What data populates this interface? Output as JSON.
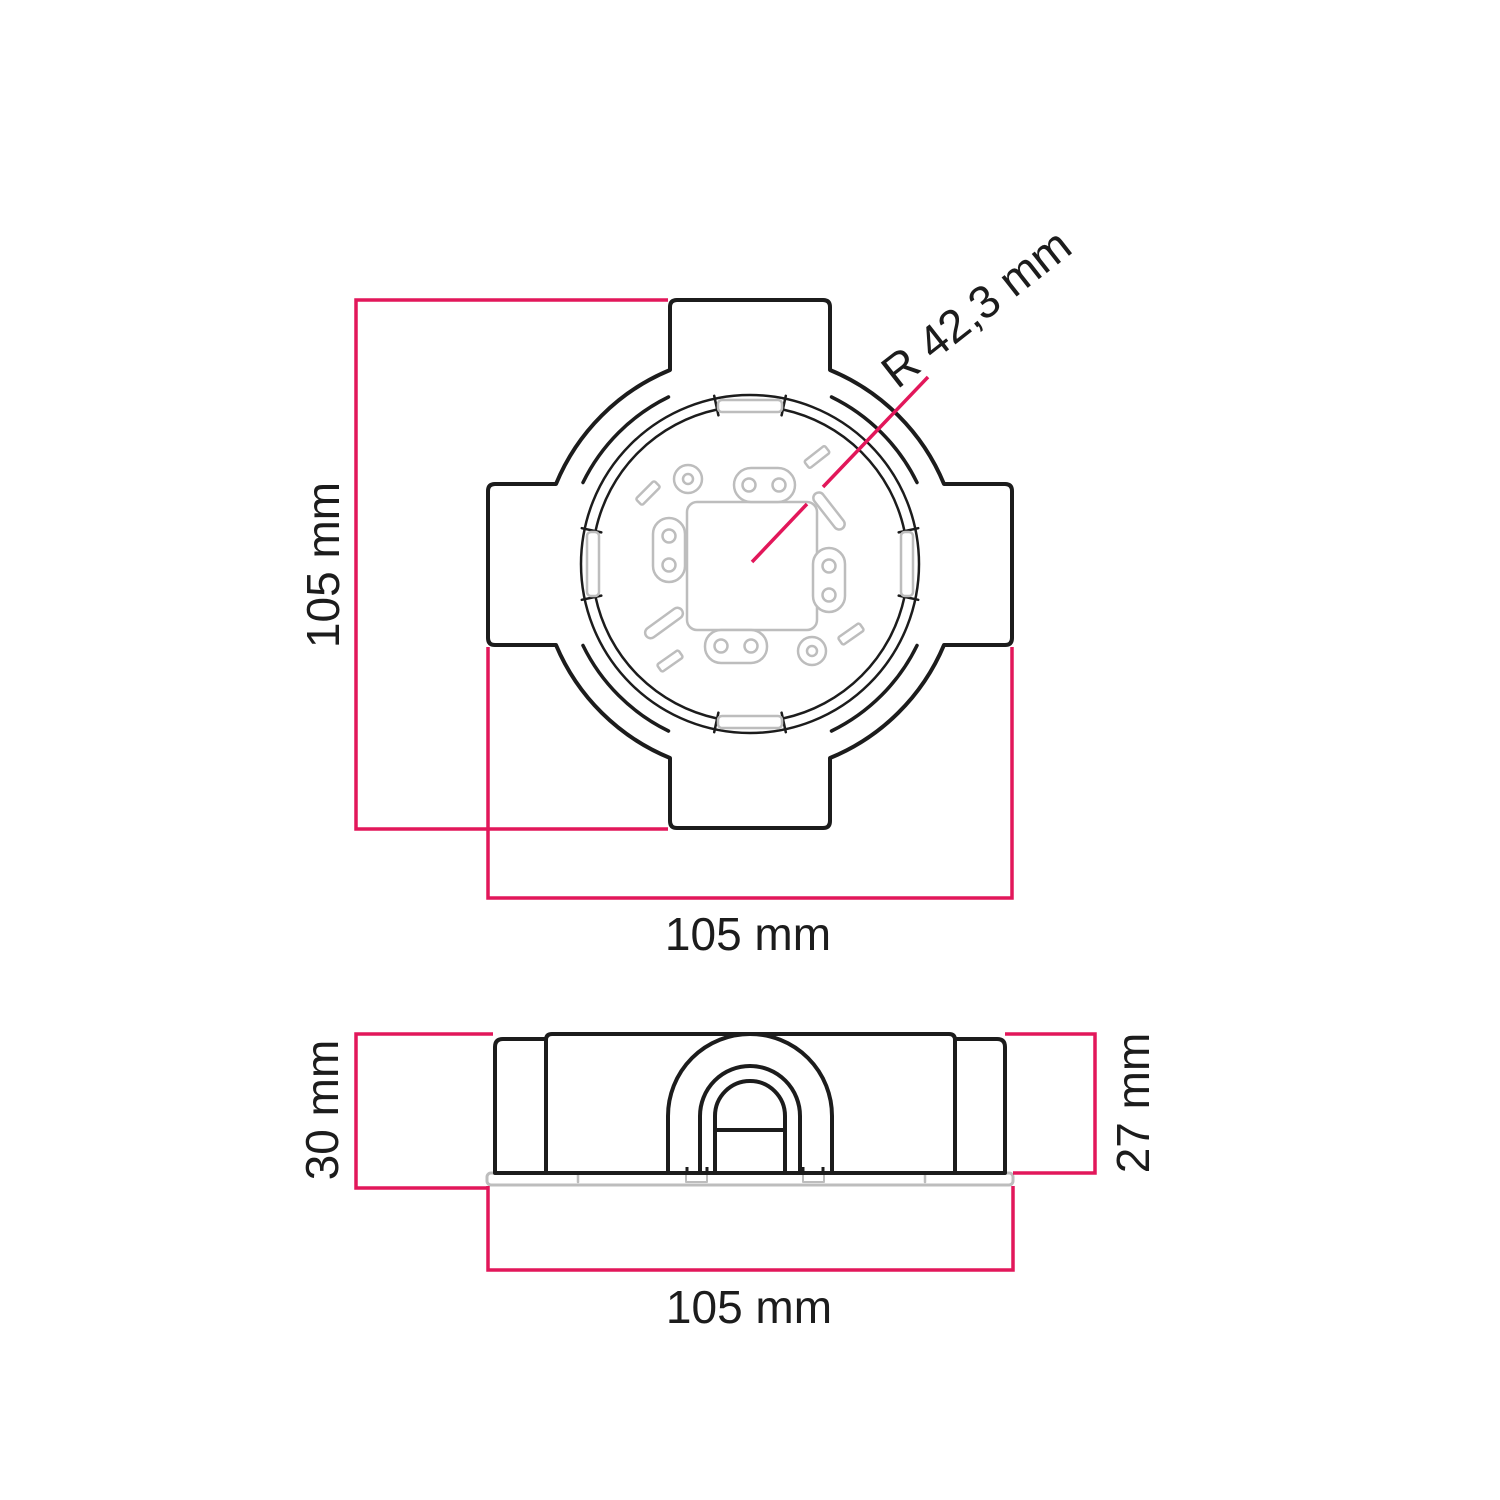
{
  "drawing": {
    "type": "technical-dimension-drawing",
    "colors": {
      "outline": "#1c1c1c",
      "detail_gray": "#bdbdbd",
      "dimension": "#e2175a",
      "text": "#1c1c1c",
      "background": "#ffffff"
    },
    "top_view": {
      "height_label": "105 mm",
      "width_label": "105 mm",
      "radius_label": "R 42,3 mm"
    },
    "side_view": {
      "total_depth_label": "30 mm",
      "body_depth_label": "27 mm",
      "width_label": "105 mm"
    }
  }
}
